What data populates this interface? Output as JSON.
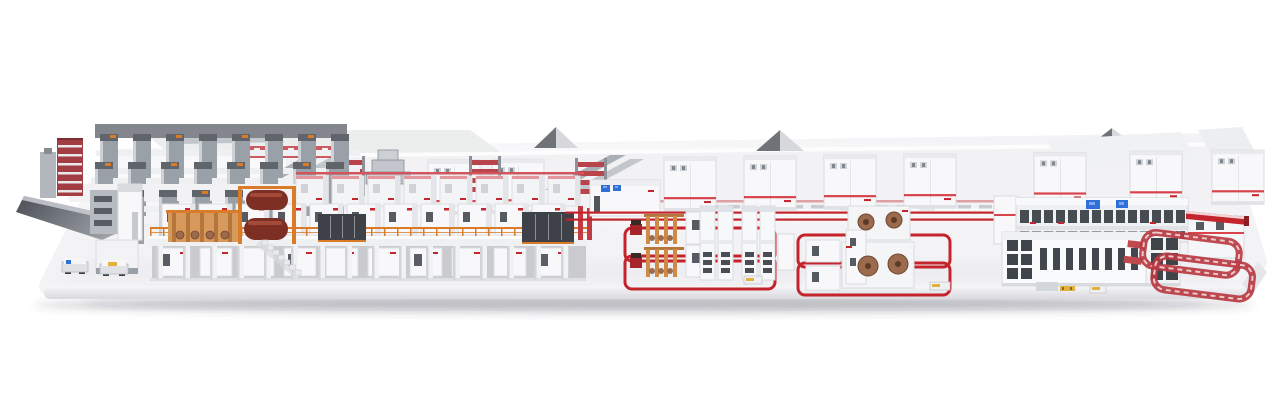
{
  "scene": {
    "type": "3d-factory-line-render",
    "colors": {
      "background": "#ffffff",
      "platform_top": "#f3f3f6",
      "platform_front_light": "#f7f7f9",
      "platform_front_dark": "#d9d9de",
      "ground_shadow": "rgba(70,70,80,0.22)",
      "machine_white": "#f8f8fa",
      "machine_outline": "#d9dbde",
      "panel_gray": "#eef0f2",
      "steel_gray": "#9aa0a8",
      "dark_steel": "#60656c",
      "dark_panel": "#3e4248",
      "window_dark": "#474c52",
      "accent_red": "#c4242c",
      "stripe_red": "#d9444c",
      "soft_red": "#d0555c",
      "rail_red": "#b93a42",
      "orange": "#d97b28",
      "wood_orange": "#cf8a45",
      "roll_brown": "#9c6a4d",
      "roll_brown_dark": "#6e462f",
      "roll_dark_red": "#7e2f24",
      "screen_blue": "#2f6fd8",
      "screen_blue_light": "#7fa8ec",
      "roof_dark": "#6f7377",
      "roof_light": "#d6d8db",
      "yellow": "#e2b13e"
    },
    "counts": {
      "reel_storage_units": 9,
      "gable_roofs": 3,
      "rack_rows": 3,
      "rack_columns": [
        8,
        8,
        5
      ],
      "corrugator_front_modules": 11,
      "corrugator_back_modules": 8,
      "corrugator_pillars": 16,
      "ground_cabinets": 10,
      "railing_posts": 34,
      "deck_paper_rolls": 2,
      "floor_rail_loops": 4,
      "roll_stand_stations": 2,
      "mounted_rolls": 4,
      "splicer_towers": 4,
      "display_screens": 4,
      "agvs": 2,
      "small_carts": 3,
      "outfeed_conveyor_loops": 2
    }
  }
}
